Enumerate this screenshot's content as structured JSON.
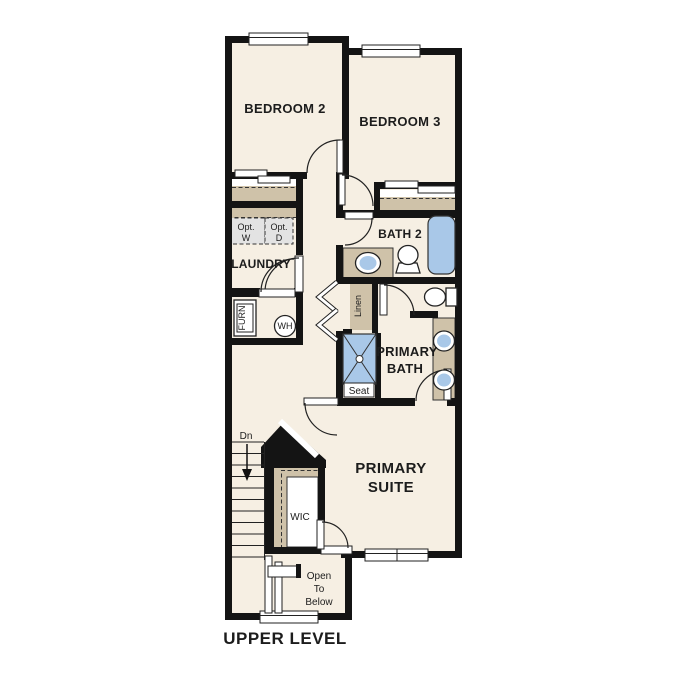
{
  "plan": {
    "title": "UPPER LEVEL",
    "rooms": {
      "bedroom2": "BEDROOM 2",
      "bedroom3": "BEDROOM 3",
      "bath2": "BATH 2",
      "laundry": "LAUNDRY",
      "primary_bath_l1": "PRIMARY",
      "primary_bath_l2": "BATH",
      "primary_suite_l1": "PRIMARY",
      "primary_suite_l2": "SUITE",
      "wic": "WIC"
    },
    "labels": {
      "opt_washer_l1": "Opt.",
      "opt_washer_l2": "W",
      "opt_dryer_l1": "Opt.",
      "opt_dryer_l2": "D",
      "furnace": "FURN",
      "water_heater": "WH",
      "linen": "Linen",
      "seat": "Seat",
      "stairs_down": "Dn",
      "open_to_below_l1": "Open",
      "open_to_below_l2": "To",
      "open_to_below_l3": "Below"
    },
    "colors": {
      "wall": "#141414",
      "floor": "#f6efe3",
      "casework_tan": "#cfc2a9",
      "fixture_blue": "#a9c8e8",
      "optional_gray": "#e3e3e3"
    }
  }
}
